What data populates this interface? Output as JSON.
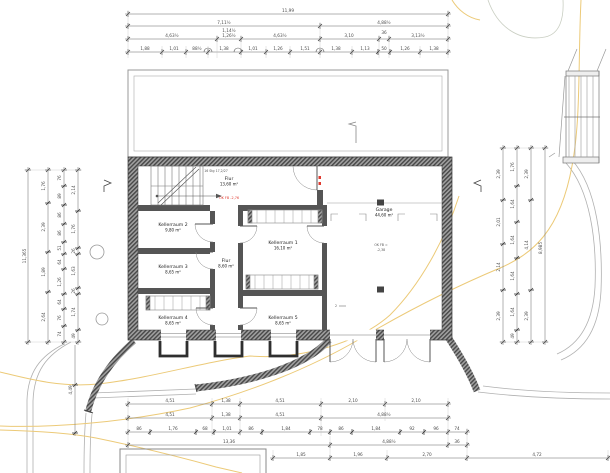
{
  "drawing": {
    "title": "Kellergeschoss Grundriss",
    "colors": {
      "wall_dark": "#474747",
      "wall_light": "#a0a0a0",
      "contour_yellow": "#ecca78",
      "annotation_red": "#e03a2f",
      "line_gray": "#b0b0b0"
    },
    "rooms": [
      {
        "name": "Flur",
        "area": "13,60 m²",
        "x": 229,
        "y": 180
      },
      {
        "name": "Kellerraum 2",
        "area": "9,80 m²",
        "x": 173,
        "y": 226
      },
      {
        "name": "Kellerraum 3",
        "area": "8,65 m²",
        "x": 173,
        "y": 268
      },
      {
        "name": "Kellerraum 4",
        "area": "8,65 m²",
        "x": 173,
        "y": 319
      },
      {
        "name": "Flur",
        "area": "8,60 m²",
        "x": 226,
        "y": 262
      },
      {
        "name": "Kellerraum 1",
        "area": "16,10 m²",
        "x": 283,
        "y": 244
      },
      {
        "name": "Kellerraum 5",
        "area": "8,65 m²",
        "x": 283,
        "y": 319
      },
      {
        "name": "Garage",
        "area": "44,60 m²",
        "x": 384,
        "y": 211
      }
    ],
    "annotations": {
      "level_corridor": "OK FB -2,76",
      "garage_level_1": "OK FB =",
      "garage_level_2": "-2,38",
      "stair_text": "16 Stg 17,2/27",
      "section_2": "2"
    },
    "chains_h": [
      {
        "y": 14,
        "x1": 125,
        "x2": 451,
        "ticks": [
          128,
          448
        ]
      },
      {
        "y": 26,
        "x1": 125,
        "x2": 451,
        "ticks": [
          128,
          320,
          448
        ]
      },
      {
        "y": 39,
        "x1": 125,
        "x2": 451,
        "ticks": [
          128,
          217,
          241,
          320,
          379,
          389,
          448
        ]
      },
      {
        "y": 52,
        "x1": 125,
        "x2": 451,
        "ticks": [
          128,
          162,
          186,
          208,
          241,
          266,
          290,
          320,
          352,
          378,
          390,
          420,
          448
        ]
      },
      {
        "y": 404,
        "x1": 125,
        "x2": 451,
        "ticks": [
          128,
          212,
          240,
          321,
          385,
          448
        ]
      },
      {
        "y": 418,
        "x1": 125,
        "x2": 451,
        "ticks": [
          128,
          212,
          240,
          321,
          448
        ]
      },
      {
        "y": 432,
        "x1": 125,
        "x2": 470,
        "ticks": [
          128,
          150,
          196,
          214,
          240,
          262,
          310,
          330,
          352,
          400,
          424,
          448,
          467
        ]
      },
      {
        "y": 445,
        "x1": 125,
        "x2": 470,
        "ticks": [
          128,
          330,
          448,
          467
        ]
      },
      {
        "y": 458,
        "x1": 270,
        "x2": 610,
        "ticks": [
          273,
          330,
          387,
          467,
          608
        ]
      }
    ],
    "chains_v": [
      {
        "x": 28,
        "y1": 167,
        "y2": 345,
        "ticks": [
          170,
          342
        ]
      },
      {
        "x": 48,
        "y1": 167,
        "y2": 345,
        "ticks": [
          170,
          203,
          252,
          292,
          342
        ]
      },
      {
        "x": 64,
        "y1": 167,
        "y2": 345,
        "ticks": [
          170,
          186,
          205,
          224,
          242,
          254,
          269,
          294,
          309,
          326,
          342
        ]
      },
      {
        "x": 78,
        "y1": 167,
        "y2": 345,
        "ticks": [
          170,
          211,
          248,
          254,
          288,
          294,
          330,
          342
        ]
      },
      {
        "x": 75,
        "y1": 345,
        "y2": 436,
        "ticks": [
          385,
          433
        ]
      },
      {
        "x": 503,
        "y1": 145,
        "y2": 345,
        "ticks": [
          148,
          200,
          244,
          290,
          342
        ]
      },
      {
        "x": 517,
        "y1": 145,
        "y2": 345,
        "ticks": [
          148,
          186,
          222,
          258,
          294,
          330,
          342
        ]
      },
      {
        "x": 531,
        "y1": 145,
        "y2": 345,
        "ticks": [
          148,
          200,
          290,
          342
        ]
      },
      {
        "x": 545,
        "y1": 145,
        "y2": 345,
        "ticks": [
          148,
          342
        ]
      }
    ],
    "ext_lines": [
      [
        128,
        10,
        128,
        58
      ],
      [
        448,
        10,
        448,
        58
      ],
      [
        320,
        22,
        320,
        58
      ],
      [
        217,
        35,
        217,
        58
      ],
      [
        241,
        35,
        241,
        58
      ],
      [
        379,
        35,
        379,
        58
      ],
      [
        389,
        35,
        389,
        58
      ],
      [
        162,
        46,
        162,
        58
      ],
      [
        186,
        46,
        186,
        58
      ],
      [
        208,
        46,
        208,
        58
      ],
      [
        266,
        46,
        266,
        58
      ],
      [
        290,
        46,
        290,
        58
      ],
      [
        352,
        46,
        352,
        58
      ],
      [
        420,
        46,
        420,
        58
      ],
      [
        128,
        398,
        128,
        448
      ],
      [
        212,
        398,
        212,
        436
      ],
      [
        240,
        398,
        240,
        436
      ],
      [
        321,
        398,
        321,
        436
      ],
      [
        385,
        398,
        385,
        421
      ],
      [
        448,
        398,
        448,
        448
      ],
      [
        467,
        428,
        467,
        461
      ],
      [
        330,
        436,
        330,
        461
      ],
      [
        273,
        450,
        273,
        461
      ],
      [
        387,
        450,
        387,
        461
      ],
      [
        608,
        450,
        608,
        461
      ],
      [
        24,
        170,
        82,
        170
      ],
      [
        24,
        342,
        82,
        342
      ],
      [
        499,
        148,
        549,
        148
      ],
      [
        499,
        342,
        549,
        342
      ]
    ],
    "dim_labels": [
      {
        "t": "11,99",
        "x": 288,
        "y": 12
      },
      {
        "t": "7,11½",
        "x": 224,
        "y": 24
      },
      {
        "t": "4,88½",
        "x": 384,
        "y": 24
      },
      {
        "t": "4,63½",
        "x": 172,
        "y": 37
      },
      {
        "t": "1,14½",
        "x": 229,
        "y": 32
      },
      {
        "t": "1,26½",
        "x": 229,
        "y": 37
      },
      {
        "t": "4,63½",
        "x": 280,
        "y": 37
      },
      {
        "t": "3,10",
        "x": 349,
        "y": 37
      },
      {
        "t": "36",
        "x": 384,
        "y": 34
      },
      {
        "t": "3,13½",
        "x": 418,
        "y": 37
      },
      {
        "t": "1,88",
        "x": 145,
        "y": 50
      },
      {
        "t": "1,01",
        "x": 174,
        "y": 50
      },
      {
        "t": "88½",
        "x": 197,
        "y": 50
      },
      {
        "t": "1,38",
        "x": 224,
        "y": 50
      },
      {
        "t": "1,01",
        "x": 253,
        "y": 50
      },
      {
        "t": "1,26",
        "x": 278,
        "y": 50
      },
      {
        "t": "1,51",
        "x": 305,
        "y": 50
      },
      {
        "t": "1,38",
        "x": 336,
        "y": 50
      },
      {
        "t": "1,13",
        "x": 365,
        "y": 50
      },
      {
        "t": "50",
        "x": 384,
        "y": 50
      },
      {
        "t": "1,26",
        "x": 405,
        "y": 50
      },
      {
        "t": "1,38",
        "x": 434,
        "y": 50
      },
      {
        "t": "4,51",
        "x": 170,
        "y": 402
      },
      {
        "t": "1,38",
        "x": 226,
        "y": 402
      },
      {
        "t": "4,51",
        "x": 280,
        "y": 402
      },
      {
        "t": "2,10",
        "x": 353,
        "y": 402
      },
      {
        "t": "2,10",
        "x": 416,
        "y": 402
      },
      {
        "t": "4,51",
        "x": 170,
        "y": 416
      },
      {
        "t": "1,38",
        "x": 226,
        "y": 416
      },
      {
        "t": "4,51",
        "x": 280,
        "y": 416
      },
      {
        "t": "4,88½",
        "x": 384,
        "y": 416
      },
      {
        "t": "86",
        "x": 139,
        "y": 430
      },
      {
        "t": "1,76",
        "x": 173,
        "y": 430
      },
      {
        "t": "68",
        "x": 205,
        "y": 430
      },
      {
        "t": "1,01",
        "x": 227,
        "y": 430
      },
      {
        "t": "86",
        "x": 251,
        "y": 430
      },
      {
        "t": "1,84",
        "x": 286,
        "y": 430
      },
      {
        "t": "78",
        "x": 320,
        "y": 430
      },
      {
        "t": "86",
        "x": 341,
        "y": 430
      },
      {
        "t": "1,84",
        "x": 376,
        "y": 430
      },
      {
        "t": "92",
        "x": 412,
        "y": 430
      },
      {
        "t": "96",
        "x": 436,
        "y": 430
      },
      {
        "t": "74",
        "x": 457,
        "y": 430
      },
      {
        "t": "13,36",
        "x": 229,
        "y": 443
      },
      {
        "t": "4,88½",
        "x": 389,
        "y": 443
      },
      {
        "t": "36",
        "x": 457,
        "y": 443
      },
      {
        "t": "1,85",
        "x": 301,
        "y": 456
      },
      {
        "t": "1,96",
        "x": 358,
        "y": 456
      },
      {
        "t": "2,70",
        "x": 427,
        "y": 456
      },
      {
        "t": "4,72",
        "x": 537,
        "y": 456
      },
      {
        "t": "11,365",
        "x": 26,
        "y": 256,
        "r": -90
      },
      {
        "t": "1,76",
        "x": 45,
        "y": 186,
        "r": -90
      },
      {
        "t": "2,39",
        "x": 45,
        "y": 227,
        "r": -90
      },
      {
        "t": "1,89",
        "x": 45,
        "y": 272,
        "r": -90
      },
      {
        "t": "2,64",
        "x": 45,
        "y": 317,
        "r": -90
      },
      {
        "t": "76",
        "x": 61,
        "y": 178,
        "r": -90
      },
      {
        "t": "89",
        "x": 61,
        "y": 196,
        "r": -90
      },
      {
        "t": "86",
        "x": 61,
        "y": 215,
        "r": -90
      },
      {
        "t": "86",
        "x": 61,
        "y": 233,
        "r": -90
      },
      {
        "t": "51",
        "x": 61,
        "y": 248,
        "r": -90
      },
      {
        "t": "64",
        "x": 61,
        "y": 262,
        "r": -90
      },
      {
        "t": "1,26",
        "x": 61,
        "y": 282,
        "r": -90
      },
      {
        "t": "64",
        "x": 61,
        "y": 302,
        "r": -90
      },
      {
        "t": "76",
        "x": 61,
        "y": 318,
        "r": -90
      },
      {
        "t": "74",
        "x": 61,
        "y": 334,
        "r": -90
      },
      {
        "t": "2,14",
        "x": 75,
        "y": 190,
        "r": -90
      },
      {
        "t": "1,76",
        "x": 75,
        "y": 229,
        "r": -90
      },
      {
        "t": "26",
        "x": 75,
        "y": 251,
        "r": -90
      },
      {
        "t": "1,63",
        "x": 75,
        "y": 271,
        "r": -90
      },
      {
        "t": "26",
        "x": 75,
        "y": 291,
        "r": -90
      },
      {
        "t": "1,74",
        "x": 75,
        "y": 312,
        "r": -90
      },
      {
        "t": "49",
        "x": 75,
        "y": 336,
        "r": -90
      },
      {
        "t": "4,49",
        "x": 72,
        "y": 390,
        "r": -90
      },
      {
        "t": "2,39",
        "x": 500,
        "y": 174,
        "r": -90
      },
      {
        "t": "2,01",
        "x": 500,
        "y": 222,
        "r": -90
      },
      {
        "t": "2,14",
        "x": 500,
        "y": 267,
        "r": -90
      },
      {
        "t": "2,39",
        "x": 500,
        "y": 316,
        "r": -90
      },
      {
        "t": "1,76",
        "x": 514,
        "y": 167,
        "r": -90
      },
      {
        "t": "1,64",
        "x": 514,
        "y": 204,
        "r": -90
      },
      {
        "t": "1,64",
        "x": 514,
        "y": 240,
        "r": -90
      },
      {
        "t": "1,64",
        "x": 514,
        "y": 276,
        "r": -90
      },
      {
        "t": "1,64",
        "x": 514,
        "y": 312,
        "r": -90
      },
      {
        "t": "49",
        "x": 514,
        "y": 336,
        "r": -90
      },
      {
        "t": "2,39",
        "x": 528,
        "y": 174,
        "r": -90
      },
      {
        "t": "4,14",
        "x": 528,
        "y": 245,
        "r": -90
      },
      {
        "t": "2,39",
        "x": 528,
        "y": 316,
        "r": -90
      },
      {
        "t": "8,985",
        "x": 542,
        "y": 248,
        "r": -90
      }
    ]
  }
}
